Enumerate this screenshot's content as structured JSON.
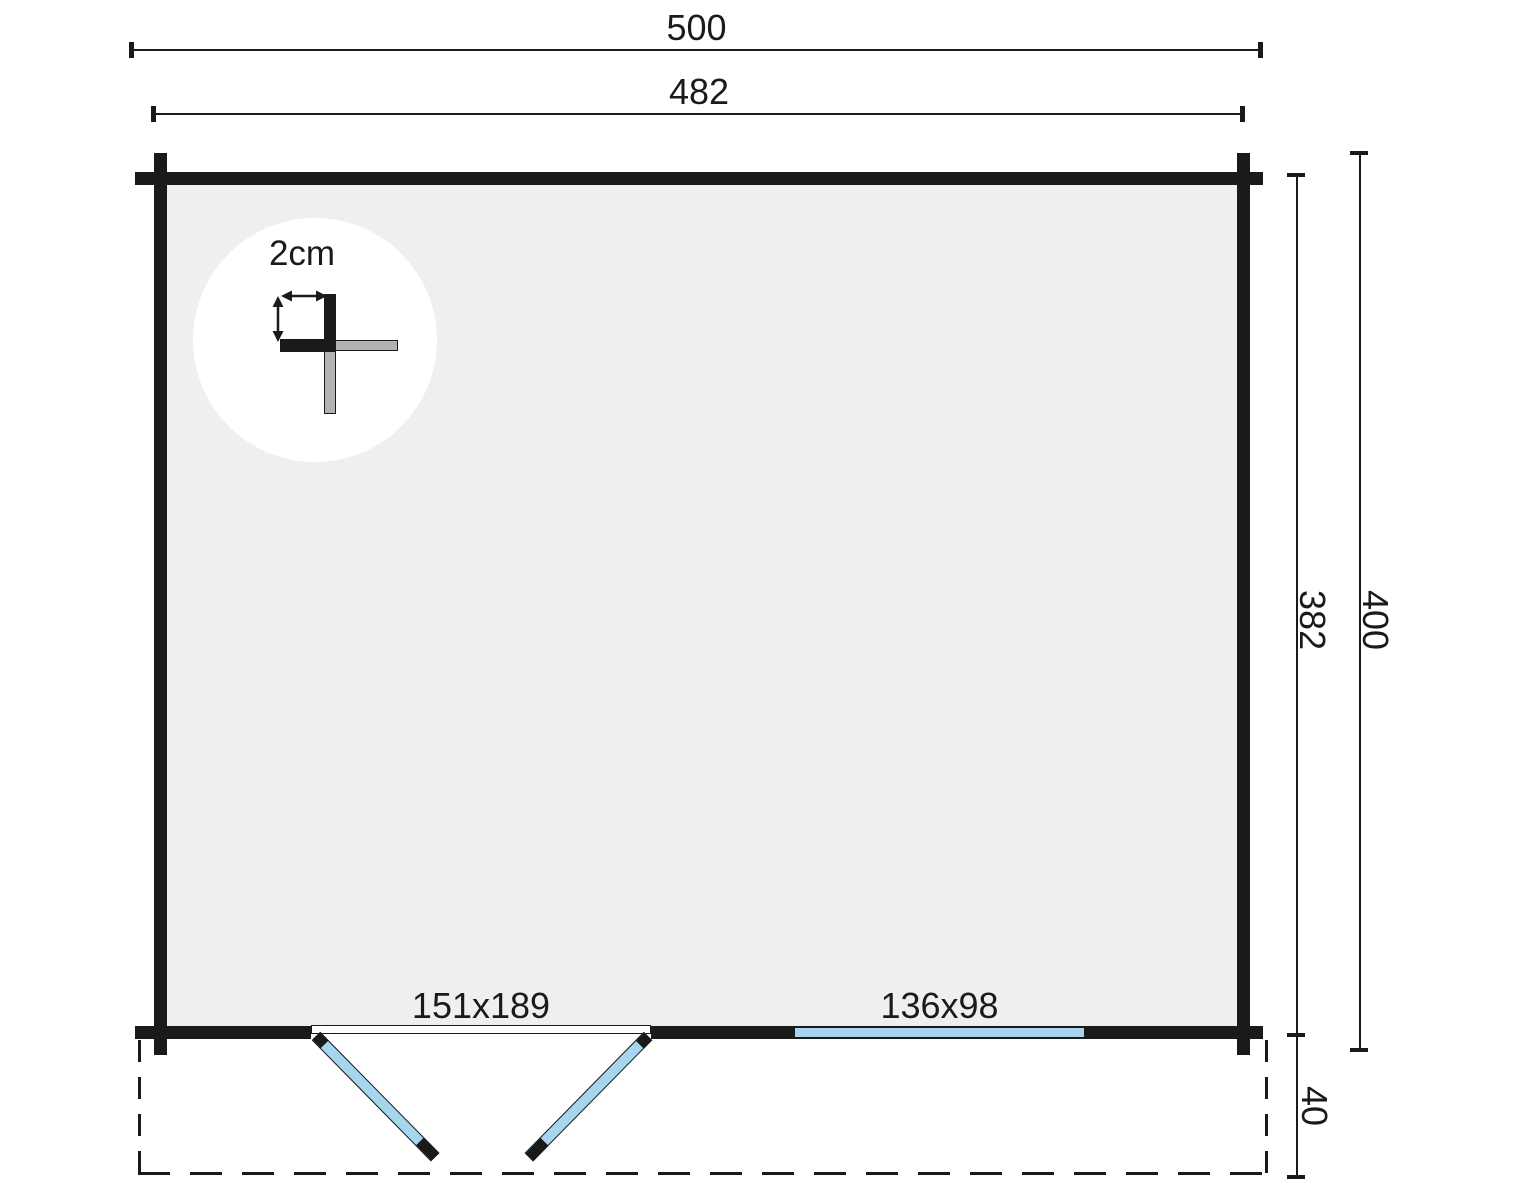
{
  "plan": {
    "dimensions": {
      "outer_width": "500",
      "inner_width": "482",
      "inner_depth": "382",
      "outer_depth": "400",
      "terrace_depth": "40"
    },
    "door": {
      "size_label": "151x189"
    },
    "window": {
      "size_label": "136x98"
    },
    "wall_detail": {
      "thickness_label": "2cm"
    },
    "colors": {
      "line": "#1a1a18",
      "interior_fill": "#efefef",
      "glazing_blue": "#a6d6ef",
      "log_end_gray": "#b2b2b2"
    }
  }
}
